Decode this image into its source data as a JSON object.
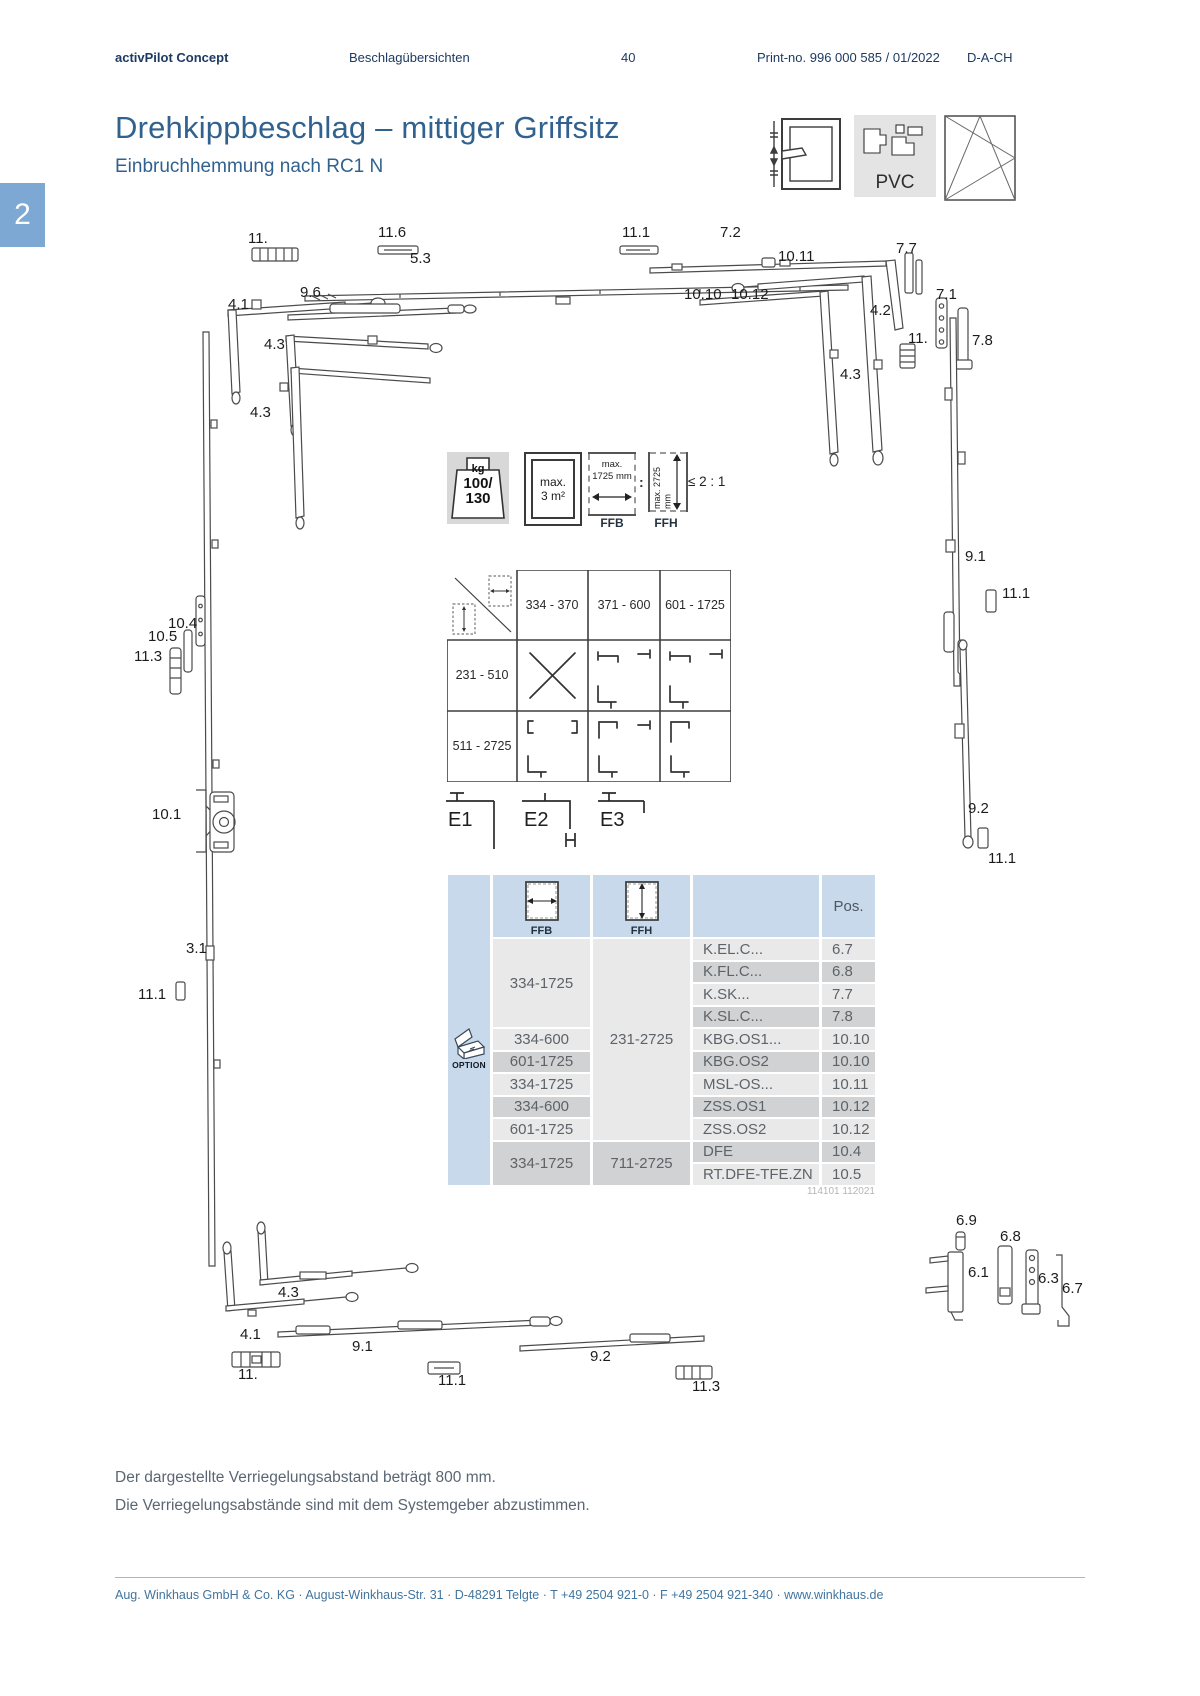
{
  "header": {
    "brand": "activPilot Concept",
    "section": "Beschlagübersichten",
    "page_number": "40",
    "print_no": "Print-no. 996 000 585 / 01/2022",
    "region": "D-A-CH"
  },
  "chapter_tab": "2",
  "title": "Drehkippbeschlag – mittiger Griffsitz",
  "subtitle": "Einbruchhemmung nach RC1 N",
  "profile_label": "PVC",
  "badges": {
    "weight": {
      "unit": "kg",
      "value_line1": "100/",
      "value_line2": "130"
    },
    "area": {
      "line1": "max.",
      "line2": "3 m²"
    },
    "ffb": {
      "line1": "max.",
      "line2": "1725 mm",
      "label": "FFB"
    },
    "colon": ":",
    "ffh": {
      "line1": "max.",
      "line2": "2725 mm",
      "label": "FFH"
    },
    "ratio": "≤ 2 : 1"
  },
  "matrix": {
    "col_headers": [
      "334 - 370",
      "371 - 600",
      "601 - 1725"
    ],
    "row_headers": [
      "231 - 510",
      "511 - 2725"
    ]
  },
  "schemes": [
    {
      "label": "E1"
    },
    {
      "label": "E2"
    },
    {
      "label": "E3"
    }
  ],
  "table": {
    "ffb_label": "FFB",
    "ffh_label": "FFH",
    "pos_header": "Pos.",
    "option_label": "OPTION",
    "ffb_cells": [
      {
        "value": "334-1725"
      },
      {
        "value": "334-600"
      },
      {
        "value": "601-1725"
      },
      {
        "value": "334-1725"
      },
      {
        "value": "334-600"
      },
      {
        "value": "601-1725"
      },
      {
        "value": "334-1725"
      }
    ],
    "ffh_cells": [
      {
        "value": "231-2725"
      },
      {
        "value": "711-2725"
      }
    ],
    "rows": [
      {
        "name": "K.EL.C...",
        "pos": "6.7"
      },
      {
        "name": "K.FL.C...",
        "pos": "6.8"
      },
      {
        "name": "K.SK...",
        "pos": "7.7"
      },
      {
        "name": "K.SL.C...",
        "pos": "7.8"
      },
      {
        "name": "KBG.OS1...",
        "pos": "10.10"
      },
      {
        "name": "KBG.OS2",
        "pos": "10.10"
      },
      {
        "name": "MSL-OS...",
        "pos": "10.11"
      },
      {
        "name": "ZSS.OS1",
        "pos": "10.12"
      },
      {
        "name": "ZSS.OS2",
        "pos": "10.12"
      },
      {
        "name": "DFE",
        "pos": "10.4"
      },
      {
        "name": "RT.DFE-TFE.ZN",
        "pos": "10.5"
      }
    ]
  },
  "doc_number": "114101 112021",
  "notes": [
    "Der dargestellte Verriegelungsabstand beträgt 800 mm.",
    "Die Verriegelungsabstände sind mit dem Systemgeber abzustimmen."
  ],
  "footer": "Aug. Winkhaus GmbH & Co. KG · August-Winkhaus-Str. 31 · D-48291 Telgte · T +49 2504 921-0 · F +49 2504 921-340 · www.winkhaus.de",
  "diagram": {
    "labels": [
      {
        "text": "11.",
        "x": 248,
        "y": 230
      },
      {
        "text": "11.6",
        "x": 378,
        "y": 224
      },
      {
        "text": "5.3",
        "x": 410,
        "y": 250
      },
      {
        "text": "11.1",
        "x": 622,
        "y": 224
      },
      {
        "text": "7.2",
        "x": 720,
        "y": 224
      },
      {
        "text": "10.11",
        "x": 778,
        "y": 248
      },
      {
        "text": "7.7",
        "x": 896,
        "y": 240
      },
      {
        "text": "4.1",
        "x": 228,
        "y": 296
      },
      {
        "text": "9.6",
        "x": 300,
        "y": 284
      },
      {
        "text": "10.10",
        "x": 684,
        "y": 286
      },
      {
        "text": "10.12",
        "x": 731,
        "y": 286
      },
      {
        "text": "4.2",
        "x": 870,
        "y": 302
      },
      {
        "text": "7.1",
        "x": 936,
        "y": 286
      },
      {
        "text": "11.",
        "x": 908,
        "y": 330
      },
      {
        "text": "7.8",
        "x": 972,
        "y": 332
      },
      {
        "text": "4.3",
        "x": 264,
        "y": 336
      },
      {
        "text": "4.3",
        "x": 250,
        "y": 404
      },
      {
        "text": "4.3",
        "x": 840,
        "y": 366
      },
      {
        "text": "9.1",
        "x": 965,
        "y": 548
      },
      {
        "text": "11.1",
        "x": 1002,
        "y": 585
      },
      {
        "text": "10.4",
        "x": 168,
        "y": 615
      },
      {
        "text": "10.5",
        "x": 148,
        "y": 628
      },
      {
        "text": "11.3",
        "x": 134,
        "y": 648
      },
      {
        "text": "10.1",
        "x": 152,
        "y": 806
      },
      {
        "text": "9.2",
        "x": 968,
        "y": 800
      },
      {
        "text": "11.1",
        "x": 988,
        "y": 850
      },
      {
        "text": "3.1",
        "x": 186,
        "y": 940
      },
      {
        "text": "11.1",
        "x": 138,
        "y": 986
      },
      {
        "text": "6.9",
        "x": 956,
        "y": 1212
      },
      {
        "text": "6.8",
        "x": 1000,
        "y": 1228
      },
      {
        "text": "6.1",
        "x": 968,
        "y": 1264
      },
      {
        "text": "6.3",
        "x": 1038,
        "y": 1270
      },
      {
        "text": "6.7",
        "x": 1062,
        "y": 1280
      },
      {
        "text": "4.3",
        "x": 278,
        "y": 1284
      },
      {
        "text": "4.1",
        "x": 240,
        "y": 1326
      },
      {
        "text": "11.",
        "x": 238,
        "y": 1366
      },
      {
        "text": "9.1",
        "x": 352,
        "y": 1338
      },
      {
        "text": "11.1",
        "x": 438,
        "y": 1372
      },
      {
        "text": "9.2",
        "x": 590,
        "y": 1348
      },
      {
        "text": "11.3",
        "x": 692,
        "y": 1378
      }
    ]
  }
}
